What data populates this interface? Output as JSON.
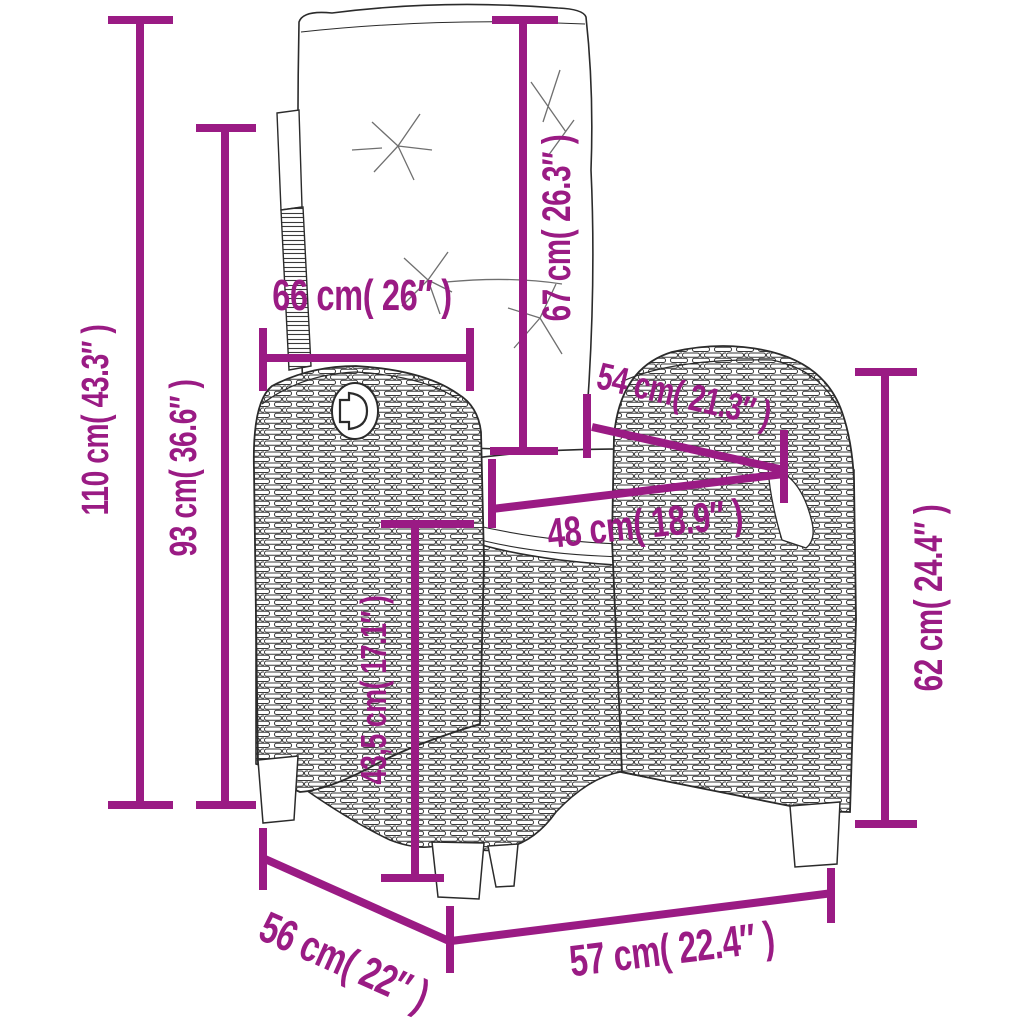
{
  "diagram": {
    "kind": "product-dimension-diagram",
    "subject": "reclining rattan garden chair with back and seat cushions",
    "accent_color": "#9A1B84",
    "outline_color": "#2b2b2b",
    "background_color": "#ffffff",
    "measurements": [
      {
        "id": "total-height",
        "label": "110 cm( 43.3″ )",
        "orientation": "vertical"
      },
      {
        "id": "back-top-height",
        "label": "93 cm( 36.6″ )",
        "orientation": "vertical"
      },
      {
        "id": "backrest-width",
        "label": "66 cm( 26″ )",
        "orientation": "horizontal"
      },
      {
        "id": "backrest-height",
        "label": "67 cm( 26.3″ )",
        "orientation": "vertical"
      },
      {
        "id": "seat-depth",
        "label": "54 cm( 21.3″ )",
        "orientation": "diagonal"
      },
      {
        "id": "seat-width",
        "label": "48 cm( 18.9″ )",
        "orientation": "horizontal"
      },
      {
        "id": "seat-height",
        "label": "43,5 cm( 17.1″ )",
        "orientation": "vertical"
      },
      {
        "id": "armrest-height",
        "label": "62 cm( 24.4″ )",
        "orientation": "vertical"
      },
      {
        "id": "base-depth",
        "label": "56 cm( 22″ )",
        "orientation": "diagonal"
      },
      {
        "id": "base-width",
        "label": "57 cm( 22.4″ )",
        "orientation": "horizontal"
      }
    ]
  }
}
